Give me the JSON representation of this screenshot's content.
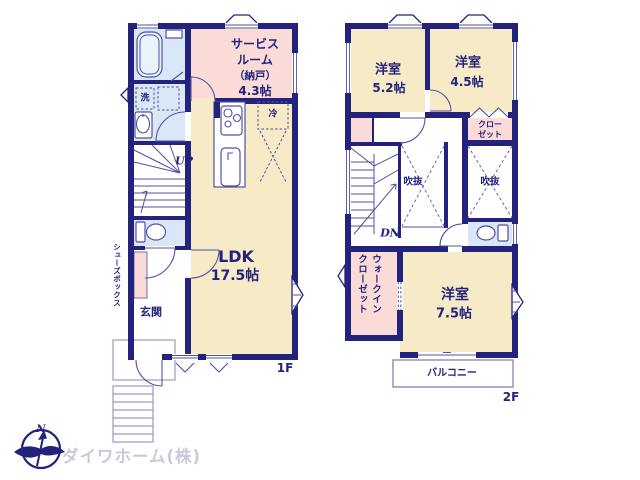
{
  "colors": {
    "wall": "#23237d",
    "room_cream": "#f6ebc6",
    "room_pink": "#fadbd8",
    "room_blue": "#d9e7f6",
    "outline": "#5151a3",
    "logo_text": "#c9c9da"
  },
  "floor1": {
    "floor_label": "1F",
    "service_room": [
      "サービス",
      "ルーム",
      "（納戸）",
      "4.3帖"
    ],
    "laundry": "洗",
    "fridge": "冷",
    "stairs_up": "UP",
    "ldk_name": "LDK",
    "ldk_size": "17.5帖",
    "entrance": "玄関",
    "shoe_box": "シューズボックス"
  },
  "floor2": {
    "floor_label": "2F",
    "bedroom1_name": "洋室",
    "bedroom1_size": "5.2帖",
    "bedroom2_name": "洋室",
    "bedroom2_size": "4.5帖",
    "closet": [
      "クロー",
      "ゼット"
    ],
    "void_left": "吹抜",
    "void_right": "吹抜",
    "stairs_down": "DN",
    "walkin_closet": [
      "ウォークイン",
      "クローゼット"
    ],
    "bedroom3_name": "洋室",
    "bedroom3_size": "7.5帖",
    "balcony": "バルコニー"
  },
  "logo": {
    "compass_north": "N",
    "company": "ダイワホーム(株)"
  }
}
